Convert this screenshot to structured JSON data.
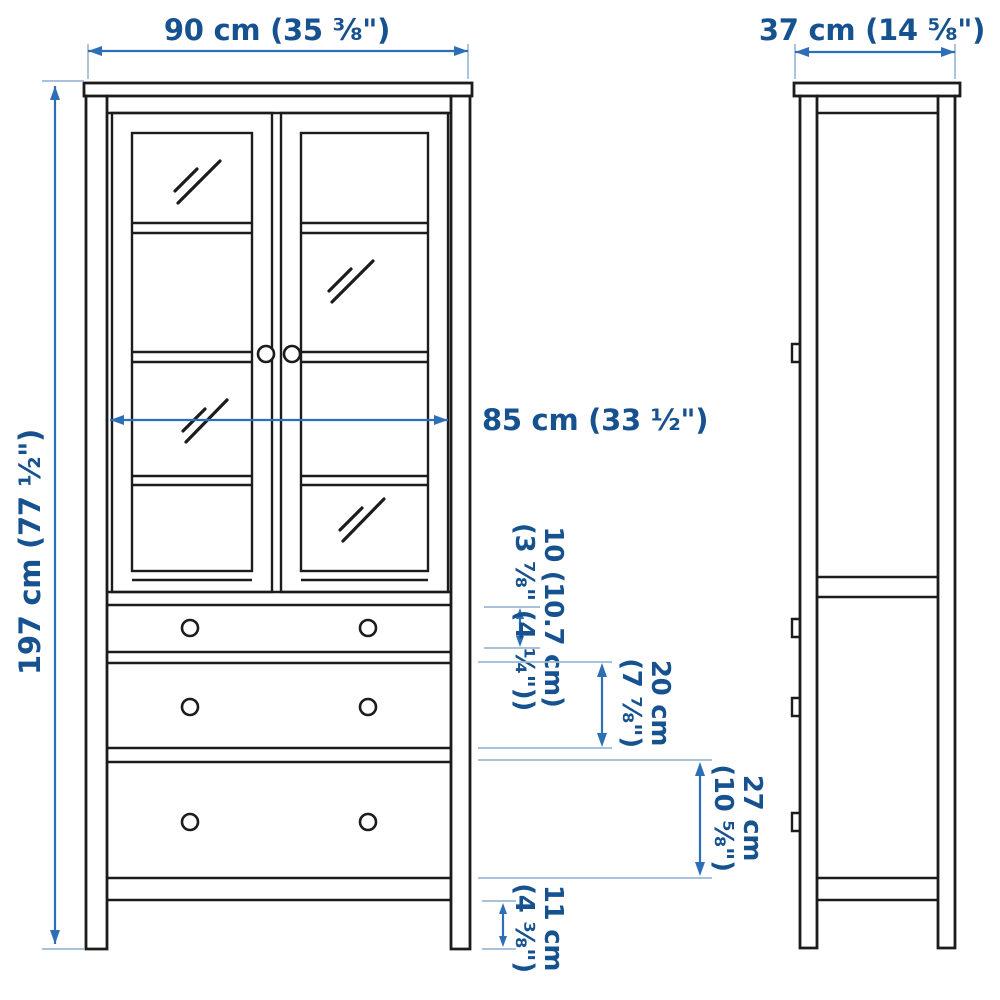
{
  "diagram_type": "furniture dimension drawing (glass-door cabinet with 3 drawers, front and side views)",
  "dimensions": {
    "width": "90 cm (35 ⅜\")",
    "depth": "37 cm (14 ⅝\")",
    "height": "197 cm (77 ½\")",
    "glass_door_width": "85 cm (33 ½\")",
    "top_drawer": {
      "line1": "10 (10.7 cm)",
      "line2": "(3 ⅞\" (4 ¼\"))"
    },
    "middle_drawer": {
      "line1": "20 cm",
      "line2": "(7 ⅞\")"
    },
    "bottom_drawer": {
      "line1": "27 cm",
      "line2": "(10 ⅝\")"
    },
    "plinth": {
      "line1": "11 cm",
      "line2": "(4 ⅜\")"
    }
  },
  "colors": {
    "background": "#ffffff",
    "outline": "#1c1c1c",
    "dimension": "#2d6fb7",
    "extension": "#9db9d6",
    "text": "#175290"
  }
}
